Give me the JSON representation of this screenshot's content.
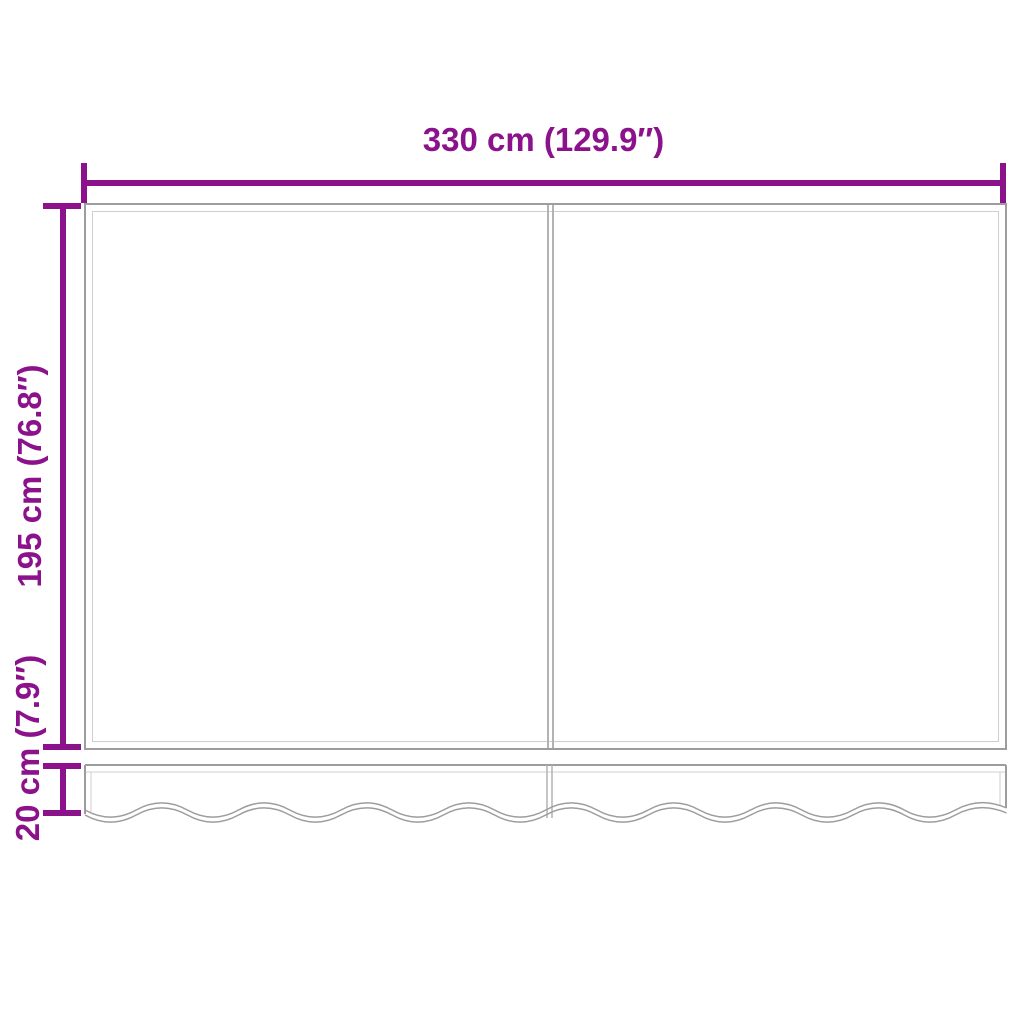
{
  "diagram": {
    "width_label": "330 cm (129.9″)",
    "height_label": "195 cm (76.8″)",
    "valance_label": "20 cm (7.9″)",
    "colors": {
      "dimension": "#8B128B",
      "outline": "#9D9D9D",
      "outline_light": "#CFCFCF",
      "divider": "#B3B3B3",
      "background": "#FFFFFF"
    }
  }
}
